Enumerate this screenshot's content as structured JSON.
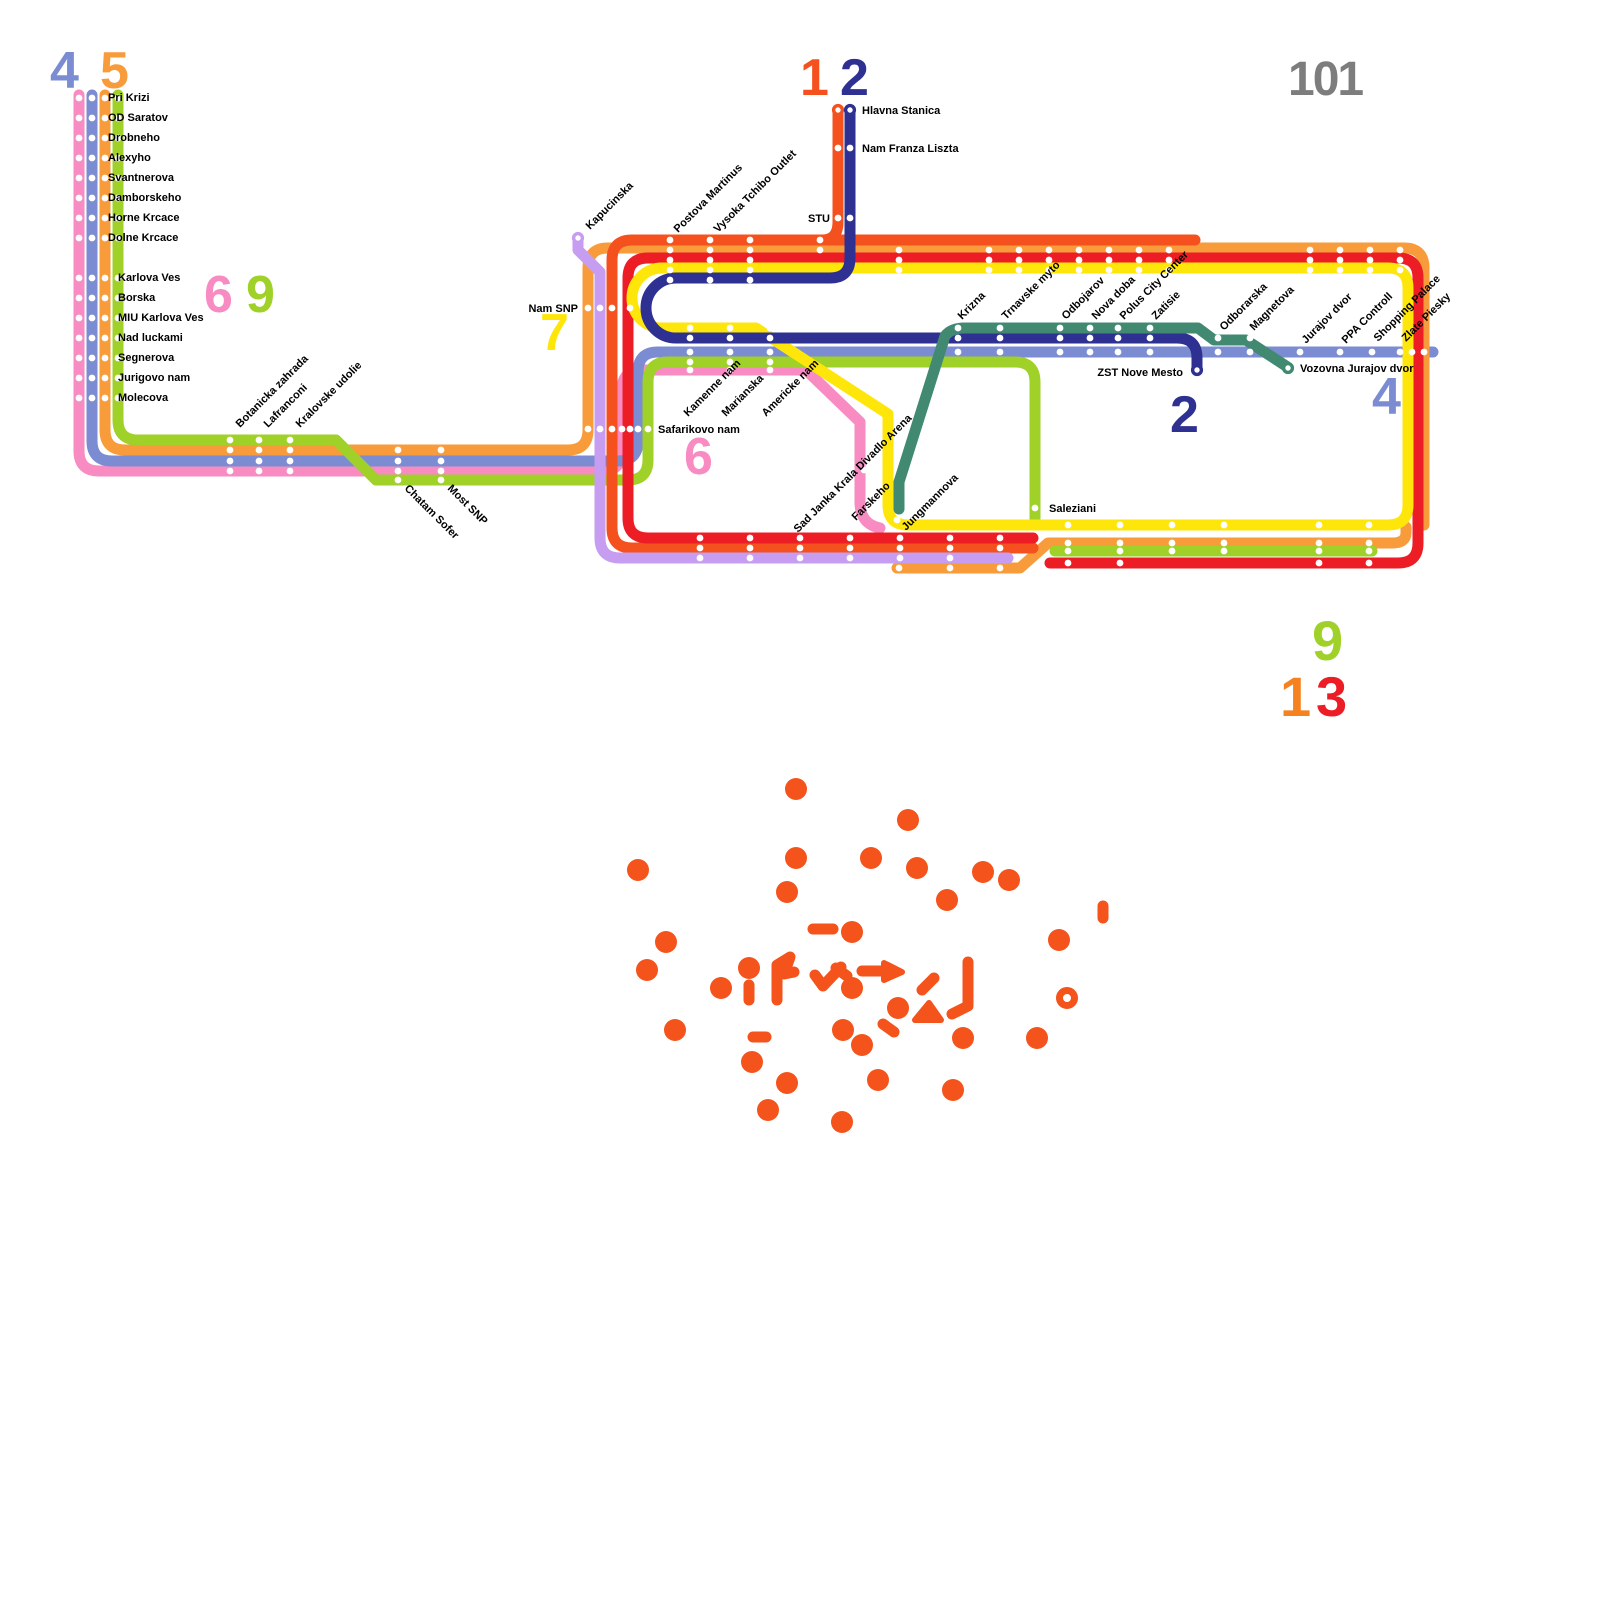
{
  "map": {
    "colors": {
      "pink": "#f78bc2",
      "blue": "#7b8cd2",
      "orange": "#f79b3b",
      "lime": "#9fd128",
      "vermillion": "#f4511e",
      "red": "#ec1d24",
      "yellow": "#ffe60a",
      "navy": "#2e3092",
      "lavender": "#c79df2",
      "teal": "#418a71",
      "gray": "#7d7d7d",
      "scatter": "#f4531c",
      "label": "#000000",
      "background": "#ffffff"
    },
    "lines": [
      {
        "id": "6-pink",
        "color": "#f78bc2",
        "d": "M 79,95 L 79,451 Q 79,471 99,471 L 602,471 Q 622,471 622,451 L 622,390 Q 622,370 642,370 L 806,370 L 860,422 L 860,502 Q 860,524 880,528"
      },
      {
        "id": "4-blue",
        "color": "#7b8cd2",
        "d": "M 92,95 L 92,441 Q 92,461 112,461 L 618,461 Q 638,461 638,441 L 638,372 Q 638,352 658,352 L 1433,352"
      },
      {
        "id": "5-orange-main",
        "color": "#f79b3b",
        "d": "M 105,95 L 105,430 Q 105,450 125,450 L 568,450 Q 588,450 588,430 L 588,268 Q 588,248 608,248 L 1404,248 Q 1424,248 1424,268 L 1424,525"
      },
      {
        "id": "5-orange-south",
        "color": "#f79b3b",
        "d": "M 897,568 L 1020,568 L 1048,543 L 1392,543 Q 1406,543 1406,533 L 1406,527"
      },
      {
        "id": "9-lime-main",
        "color": "#9fd128",
        "d": "M 118,95 L 118,420 Q 118,440 138,440 L 336,440 L 374,478 L 376,480 L 628,480 Q 648,480 648,460 L 648,382 Q 648,362 668,362 L 1015,362 Q 1035,362 1035,382 L 1035,518"
      },
      {
        "id": "9-lime-south",
        "color": "#9fd128",
        "d": "M 1055,551 L 1372,551"
      },
      {
        "id": "1-vermillion",
        "color": "#f4511e",
        "d": "M 1195,240 L 632,240 Q 612,240 612,260 L 612,528 Q 612,548 632,548 L 1033,548 M 838,112 L 838,222 Q 838,240 822,240"
      },
      {
        "id": "13-red",
        "color": "#ec1d24",
        "d": "M 648,258 L 1398,258 Q 1418,258 1418,278 L 1418,543 Q 1418,563 1398,563 L 1050,563 M 648,258 Q 628,258 628,278 L 628,518 Q 628,538 648,538 L 1033,538"
      },
      {
        "id": "7-yellow-loop",
        "color": "#ffe60a",
        "d": "M 662,268 A 30 30 0 0 0 662,328 L 756,328 L 888,414 L 888,505 Q 888,525 908,525 L 1388,525 Q 1408,525 1408,505 L 1408,288 Q 1408,268 1388,268 L 662,268 Z"
      },
      {
        "id": "2-navy",
        "color": "#2e3092",
        "d": "M 850,112 L 850,258 Q 850,278 830,278 L 676,278 A 30 30 0 0 0 676,338 L 1177,338 Q 1197,338 1197,358 L 1197,368"
      },
      {
        "id": "lavender-kapucinska",
        "color": "#c79df2",
        "d": "M 578,240 L 578,250 L 600,272 L 600,538 Q 600,558 620,558 L 1008,558"
      },
      {
        "id": "teal-line",
        "color": "#418a71",
        "d": "M 899,509 L 899,482 L 945,336 Q 951,328 965,328 L 1198,328 L 1214,340 L 1246,340 L 1286,366"
      }
    ],
    "dot_grids": [
      {
        "xs": [
          79,
          92,
          105,
          118
        ],
        "ys": [
          98,
          118,
          138,
          158,
          178,
          198,
          218,
          238,
          278,
          298,
          318,
          338,
          358,
          378,
          398
        ]
      },
      {
        "xs": [
          230,
          259,
          290
        ],
        "ys": [
          440,
          450,
          461,
          471
        ]
      },
      {
        "xs": [
          398,
          441
        ],
        "ys": [
          450,
          461,
          471,
          480
        ]
      },
      {
        "xs": [
          670,
          710,
          750
        ],
        "ys": [
          240,
          250,
          260,
          270,
          280
        ]
      },
      {
        "xs": [
          690,
          730,
          770
        ],
        "ys": [
          328,
          338,
          352,
          362,
          370
        ]
      },
      {
        "xs": [
          899,
          989,
          1019,
          1049,
          1079,
          1109,
          1139,
          1169
        ],
        "ys": [
          250,
          260,
          270
        ]
      },
      {
        "xs": [
          1310,
          1340,
          1370,
          1400
        ],
        "ys": [
          250,
          260,
          270
        ]
      },
      {
        "xs": [
          958,
          1000,
          1060,
          1090,
          1118,
          1150
        ],
        "ys": [
          328,
          338,
          352
        ]
      },
      {
        "xs": [
          1218,
          1250
        ],
        "ys": [
          338,
          352
        ]
      },
      {
        "xs": [
          1300,
          1340,
          1372,
          1400,
          1412,
          1424
        ],
        "ys": [
          352
        ]
      },
      {
        "xs": [
          1068,
          1120,
          1319,
          1369
        ],
        "ys": [
          525,
          543,
          551,
          563,
          573
        ]
      },
      {
        "xs": [
          1172,
          1224
        ],
        "ys": [
          525,
          543,
          551
        ]
      },
      {
        "xs": [
          700,
          750,
          800,
          850,
          900,
          950,
          1000
        ],
        "ys": [
          538,
          548
        ]
      },
      {
        "xs": [
          700,
          750,
          800,
          850,
          900,
          950
        ],
        "ys": [
          558
        ]
      },
      {
        "xs": [
          899,
          950,
          1000
        ],
        "ys": [
          568
        ]
      },
      {
        "xs": [
          588,
          600,
          612,
          622,
          630,
          638,
          648
        ],
        "ys": [
          429
        ]
      },
      {
        "xs": [
          588,
          600,
          612,
          630
        ],
        "ys": [
          308
        ]
      },
      {
        "xs": [
          838,
          850
        ],
        "ys": [
          148,
          218
        ]
      }
    ],
    "dot_singles": [
      [
        864,
        470
      ],
      [
        897,
        520
      ],
      [
        1035,
        508
      ],
      [
        820,
        240
      ],
      [
        820,
        250
      ]
    ],
    "termini": [
      {
        "x": 578,
        "y": 238,
        "color": "#c79df2"
      },
      {
        "x": 838,
        "y": 110,
        "color": "#f4511e"
      },
      {
        "x": 850,
        "y": 110,
        "color": "#2e3092"
      },
      {
        "x": 1197,
        "y": 370,
        "color": "#2e3092"
      },
      {
        "x": 1288,
        "y": 368,
        "color": "#418a71"
      }
    ],
    "labels": [
      {
        "t": "Pri Krizi",
        "x": 108,
        "y": 101
      },
      {
        "t": "OD Saratov",
        "x": 108,
        "y": 121
      },
      {
        "t": "Drobneho",
        "x": 108,
        "y": 141
      },
      {
        "t": "Alexyho",
        "x": 108,
        "y": 161
      },
      {
        "t": "Svantnerova",
        "x": 108,
        "y": 181
      },
      {
        "t": "Damborskeho",
        "x": 108,
        "y": 201
      },
      {
        "t": "Horne Krcace",
        "x": 108,
        "y": 221
      },
      {
        "t": "Dolne Krcace",
        "x": 108,
        "y": 241
      },
      {
        "t": "Karlova Ves",
        "x": 118,
        "y": 281
      },
      {
        "t": "Borska",
        "x": 118,
        "y": 301
      },
      {
        "t": "MIU Karlova Ves",
        "x": 118,
        "y": 321
      },
      {
        "t": "Nad luckami",
        "x": 118,
        "y": 341
      },
      {
        "t": "Segnerova",
        "x": 118,
        "y": 361
      },
      {
        "t": "Jurigovo nam",
        "x": 118,
        "y": 381
      },
      {
        "t": "Molecova",
        "x": 118,
        "y": 401
      },
      {
        "t": "Botanicka zahrada",
        "x": 240,
        "y": 428,
        "r": -45
      },
      {
        "t": "Lafranconi",
        "x": 268,
        "y": 428,
        "r": -45
      },
      {
        "t": "Kralovske udolie",
        "x": 300,
        "y": 428,
        "r": -45
      },
      {
        "t": "Chatam Sofer",
        "x": 404,
        "y": 489,
        "r": 45
      },
      {
        "t": "Most SNP",
        "x": 447,
        "y": 489,
        "r": 45
      },
      {
        "t": "Kapucinska",
        "x": 590,
        "y": 230,
        "r": -45
      },
      {
        "t": "Nam SNP",
        "x": 578,
        "y": 312,
        "a": "end"
      },
      {
        "t": "Safarikovo nam",
        "x": 658,
        "y": 433
      },
      {
        "t": "Postova Martinus",
        "x": 678,
        "y": 233,
        "r": -45
      },
      {
        "t": "Vysoka Tchibo Outlet",
        "x": 718,
        "y": 233,
        "r": -45
      },
      {
        "t": "STU",
        "x": 830,
        "y": 222,
        "a": "end"
      },
      {
        "t": "Hlavna Stanica",
        "x": 862,
        "y": 114
      },
      {
        "t": "Nam Franza Liszta",
        "x": 862,
        "y": 152
      },
      {
        "t": "Kamenne nam",
        "x": 688,
        "y": 417,
        "r": -45
      },
      {
        "t": "Marianska",
        "x": 726,
        "y": 417,
        "r": -45
      },
      {
        "t": "Americke nam",
        "x": 766,
        "y": 417,
        "r": -45
      },
      {
        "t": "Krizna",
        "x": 962,
        "y": 320,
        "r": -45
      },
      {
        "t": "Trnavske myto",
        "x": 1006,
        "y": 320,
        "r": -45
      },
      {
        "t": "Odbojarov",
        "x": 1066,
        "y": 320,
        "r": -45
      },
      {
        "t": "Nova doba",
        "x": 1096,
        "y": 320,
        "r": -45
      },
      {
        "t": "Polus City Center",
        "x": 1124,
        "y": 320,
        "r": -45
      },
      {
        "t": "Zatisie",
        "x": 1156,
        "y": 320,
        "r": -45
      },
      {
        "t": "Odborarska",
        "x": 1224,
        "y": 331,
        "r": -45
      },
      {
        "t": "Magnetova",
        "x": 1254,
        "y": 331,
        "r": -45
      },
      {
        "t": "Jurajov dvor",
        "x": 1306,
        "y": 344,
        "r": -45
      },
      {
        "t": "PPA Controll",
        "x": 1346,
        "y": 344,
        "r": -45
      },
      {
        "t": "Shopping Palace",
        "x": 1378,
        "y": 342,
        "r": -45
      },
      {
        "t": "Zlate Piesky",
        "x": 1406,
        "y": 342,
        "r": -45
      },
      {
        "t": "ZST Nove Mesto",
        "x": 1183,
        "y": 376,
        "a": "end"
      },
      {
        "t": "Vozovna Jurajov dvor",
        "x": 1300,
        "y": 372
      },
      {
        "t": "Sad Janka Krala Divadlo Arena",
        "x": 798,
        "y": 533,
        "r": -45
      },
      {
        "t": "Farskeho",
        "x": 856,
        "y": 521,
        "r": -45
      },
      {
        "t": "Jungmannova",
        "x": 906,
        "y": 531,
        "r": -45
      },
      {
        "t": "Saleziani",
        "x": 1049,
        "y": 512
      }
    ],
    "badges": [
      {
        "t": "4",
        "x": 50,
        "y": 88,
        "c": "#7b8cd2",
        "s": 52
      },
      {
        "t": "5",
        "x": 100,
        "y": 88,
        "c": "#f79b3b",
        "s": 52
      },
      {
        "t": "6",
        "x": 204,
        "y": 312,
        "c": "#f78bc2",
        "s": 52
      },
      {
        "t": "9",
        "x": 246,
        "y": 312,
        "c": "#9fd128",
        "s": 52
      },
      {
        "t": "1",
        "x": 800,
        "y": 95,
        "c": "#f4511e",
        "s": 52
      },
      {
        "t": "2",
        "x": 840,
        "y": 95,
        "c": "#2e3092",
        "s": 52
      },
      {
        "t": "101",
        "x": 1288,
        "y": 95,
        "c": "#7d7d7d",
        "s": 48
      },
      {
        "t": "7",
        "x": 540,
        "y": 350,
        "c": "#ffe60a",
        "s": 52
      },
      {
        "t": "6",
        "x": 684,
        "y": 474,
        "c": "#f78bc2",
        "s": 52
      },
      {
        "t": "2",
        "x": 1170,
        "y": 432,
        "c": "#2e3092",
        "s": 52
      },
      {
        "t": "4",
        "x": 1372,
        "y": 414,
        "c": "#7b8cd2",
        "s": 52
      },
      {
        "t": "9",
        "x": 1312,
        "y": 660,
        "c": "#9fd128",
        "s": 56
      },
      {
        "t": "1",
        "x": 1280,
        "y": 716,
        "c": "#f5821f",
        "s": 56
      },
      {
        "t": "3",
        "x": 1316,
        "y": 716,
        "c": "#ec1d24",
        "s": 56
      }
    ],
    "scatter": {
      "color": "#f4531c",
      "dot_r": 11,
      "dots": [
        [
          796,
          789
        ],
        [
          908,
          820
        ],
        [
          638,
          870
        ],
        [
          796,
          858
        ],
        [
          871,
          858
        ],
        [
          917,
          868
        ],
        [
          983,
          872
        ],
        [
          1009,
          880
        ],
        [
          787,
          892
        ],
        [
          947,
          900
        ],
        [
          666,
          942
        ],
        [
          1059,
          940
        ],
        [
          647,
          970
        ],
        [
          749,
          968
        ],
        [
          721,
          988
        ],
        [
          852,
          932
        ],
        [
          852,
          988
        ],
        [
          898,
          1008
        ],
        [
          675,
          1030
        ],
        [
          843,
          1030
        ],
        [
          862,
          1045
        ],
        [
          963,
          1038
        ],
        [
          1037,
          1038
        ],
        [
          752,
          1062
        ],
        [
          787,
          1083
        ],
        [
          878,
          1080
        ],
        [
          953,
          1090
        ],
        [
          768,
          1110
        ],
        [
          842,
          1122
        ]
      ],
      "ring": {
        "x": 1067,
        "y": 998,
        "r": 7.5,
        "w": 7
      },
      "bars": [
        [
          813,
          929,
          833,
          929
        ],
        [
          749,
          985,
          749,
          1000
        ],
        [
          753,
          1037,
          766,
          1037
        ],
        [
          883,
          1024,
          894,
          1032
        ],
        [
          836,
          968,
          847,
          976
        ],
        [
          1103,
          906,
          1103,
          918
        ],
        [
          922,
          990,
          934,
          978
        ]
      ],
      "shapes": [
        "M777,1000 L777,965 L790,957 L784,974 L794,972",
        "M815,975 L823,986 L841,967",
        "M952,1014 L968,1006 L968,962",
        "M862,971 L886,971"
      ],
      "polys": [
        [
          [
            884,
            963
          ],
          [
            902,
            972
          ],
          [
            884,
            980
          ]
        ],
        [
          [
            915,
            1020
          ],
          [
            941,
            1020
          ],
          [
            929,
            1003
          ]
        ]
      ]
    }
  }
}
